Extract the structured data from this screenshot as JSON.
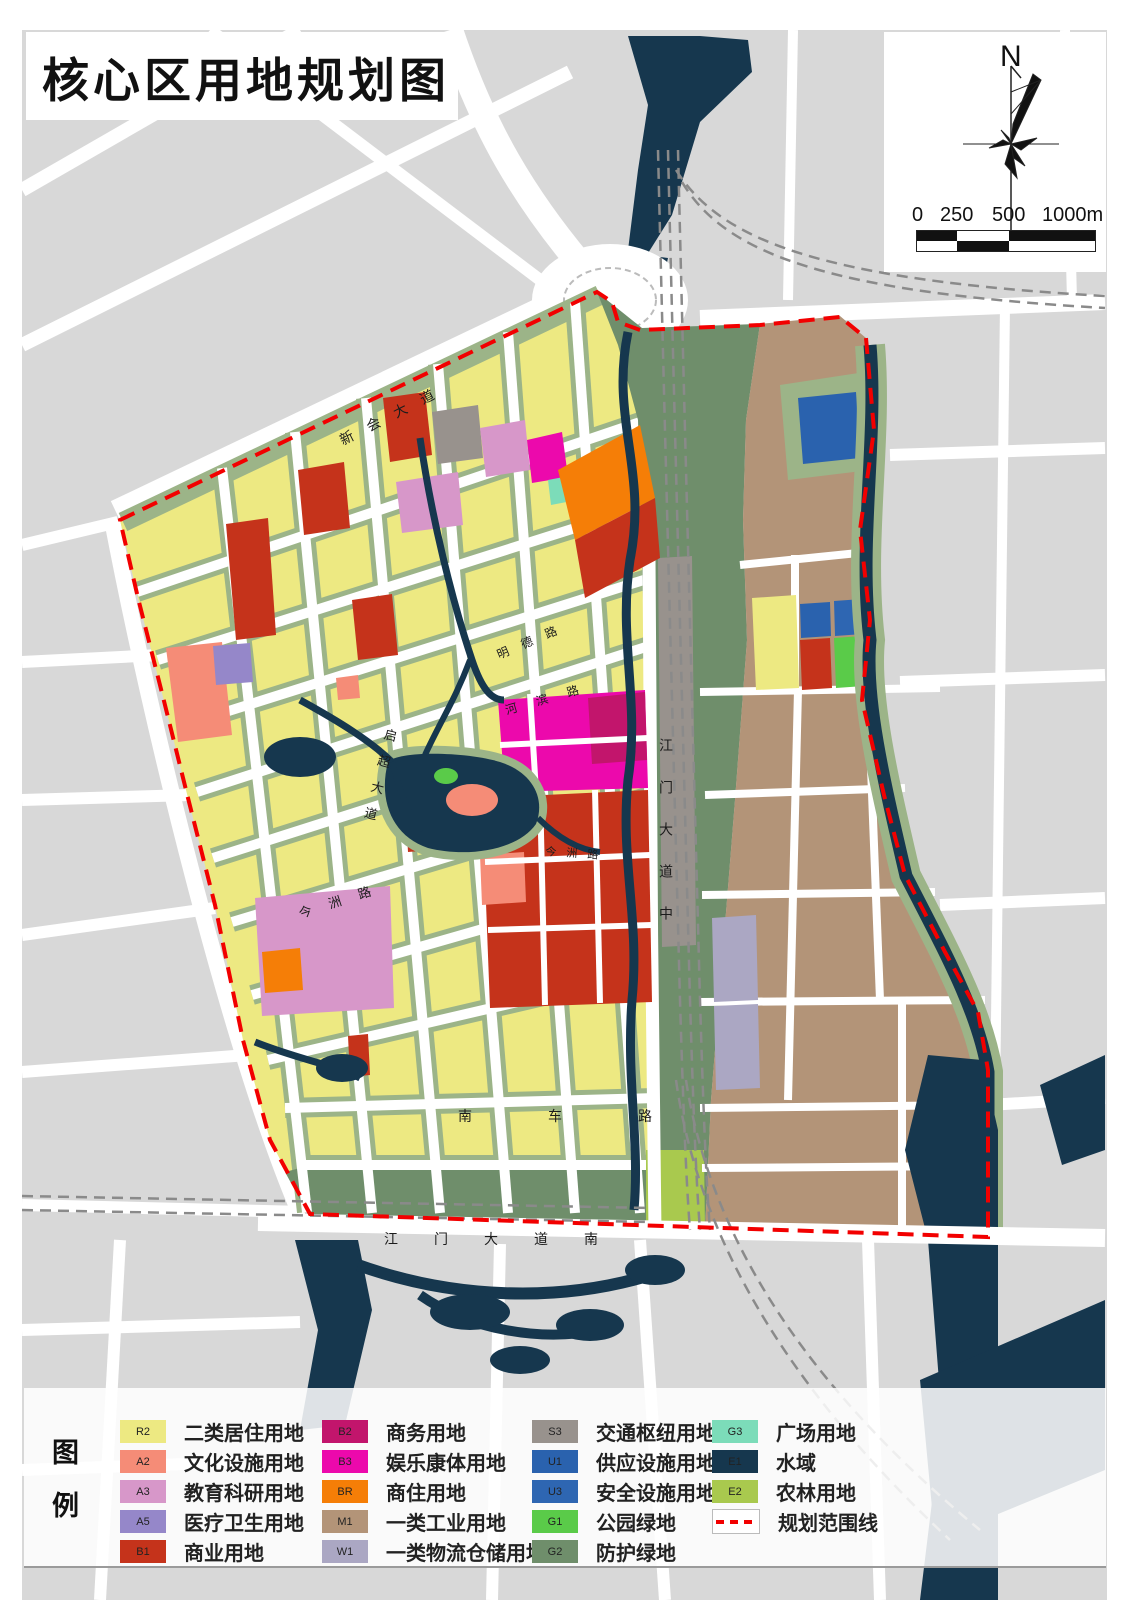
{
  "title": "核心区用地规划图",
  "compass": {
    "north_label": "N"
  },
  "scale_bar": {
    "labels": [
      "0",
      "250",
      "500",
      "1000m"
    ]
  },
  "legend": {
    "title": "图例",
    "items": [
      {
        "code": "R2",
        "label": "二类居住用地",
        "color": "#EDE982"
      },
      {
        "code": "A2",
        "label": "文化设施用地",
        "color": "#F58C77"
      },
      {
        "code": "A3",
        "label": "教育科研用地",
        "color": "#D797C9"
      },
      {
        "code": "A5",
        "label": "医疗卫生用地",
        "color": "#9587C9"
      },
      {
        "code": "B1",
        "label": "商业用地",
        "color": "#C5331B"
      },
      {
        "code": "B2",
        "label": "商务用地",
        "color": "#C2156C"
      },
      {
        "code": "B3",
        "label": "娱乐康体用地",
        "color": "#EC09AC"
      },
      {
        "code": "BR",
        "label": "商住用地",
        "color": "#F57E07"
      },
      {
        "code": "M1",
        "label": "一类工业用地",
        "color": "#B39478"
      },
      {
        "code": "W1",
        "label": "一类物流仓储用地",
        "color": "#ABA7C3"
      },
      {
        "code": "S3",
        "label": "交通枢纽用地",
        "color": "#98928D"
      },
      {
        "code": "U1",
        "label": "供应设施用地",
        "color": "#2A62AE"
      },
      {
        "code": "U3",
        "label": "安全设施用地",
        "color": "#2E66B2"
      },
      {
        "code": "G1",
        "label": "公园绿地",
        "color": "#5ACB49"
      },
      {
        "code": "G2",
        "label": "防护绿地",
        "color": "#6F8E6B"
      },
      {
        "code": "G3",
        "label": "广场用地",
        "color": "#7CDCB9"
      },
      {
        "code": "E1",
        "label": "水域",
        "color": "#16374E"
      },
      {
        "code": "E2",
        "label": "农林用地",
        "color": "#A9C94E"
      }
    ],
    "boundary": {
      "label": "规划范围线",
      "color": "#F20000"
    }
  },
  "map": {
    "road_labels": [
      {
        "text": "新会大道"
      },
      {
        "text": "明德路"
      },
      {
        "text": "河滨路"
      },
      {
        "text": "启超大道"
      },
      {
        "text": "今洲路"
      },
      {
        "text": "今洲路"
      },
      {
        "text": "江门大道中"
      },
      {
        "text": "南车路"
      },
      {
        "text": "江门大道南"
      }
    ],
    "colors": {
      "R2": "#EDE982",
      "A2": "#F58C77",
      "A3": "#D797C9",
      "A5": "#9587C9",
      "B1": "#C5331B",
      "B2": "#C2156C",
      "B3": "#EC09AC",
      "BR": "#F57E07",
      "M1": "#B39478",
      "W1": "#ABA7C3",
      "S3": "#98928D",
      "U1": "#2A62AE",
      "U3": "#2E66B2",
      "G1": "#5ACB49",
      "G2": "#6F8E6B",
      "G3": "#7CDCB9",
      "E1": "#16374E",
      "E2": "#A9C94E",
      "boundary": "#F20000",
      "road": "#FFFFFF",
      "city": "#D8D8D8",
      "block_edge": "#9CB488",
      "rail": "#8A8A8A"
    }
  }
}
